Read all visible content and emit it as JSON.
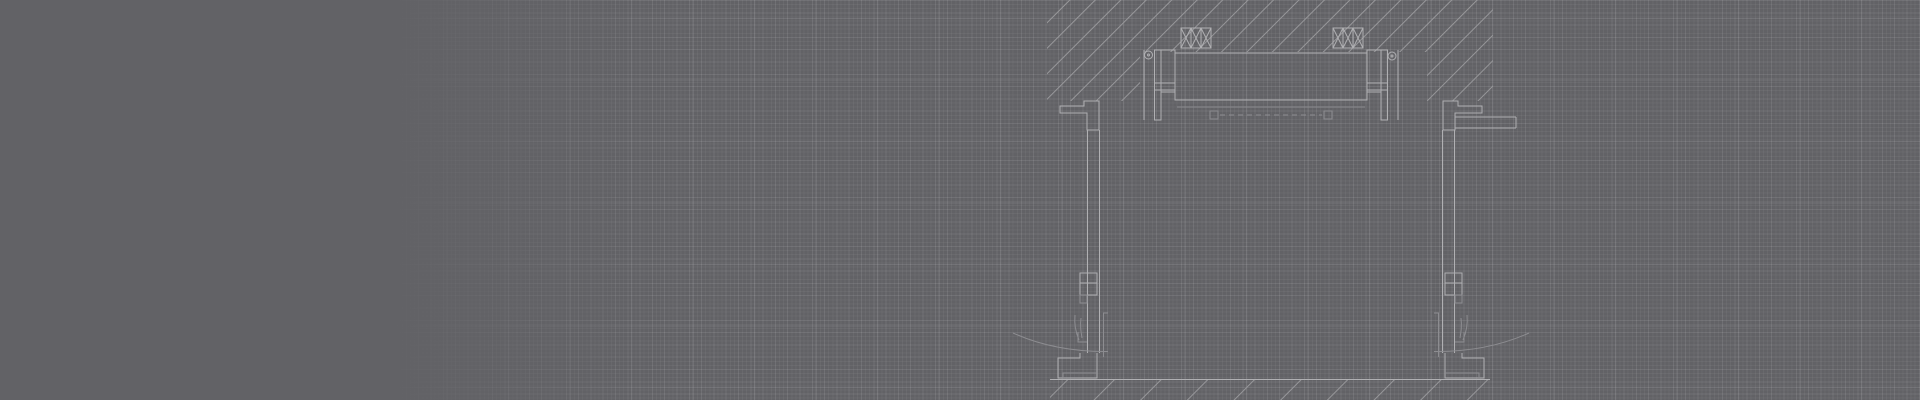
{
  "scene": {
    "background_color": "#626266",
    "grid": {
      "fine_spacing_px": 4.1,
      "fine_color": "rgba(255,255,255,0.045)",
      "medium_spacing_px": 12.3,
      "medium_color": "rgba(255,255,255,0.05)",
      "major_spacing_px": 61.5,
      "major_color": "rgba(255,255,255,0.10)",
      "major_offset_x_px": 16,
      "major_offset_y_px": 18,
      "fade_solid_until_px": 390,
      "fade_transparent_at_px": 660
    },
    "drawing": {
      "main_line_color": "#b0b0b3",
      "dim_line_color": "#8d8d91",
      "hatch_line_color": "#97979a",
      "viewbox": "0 0 1920 400",
      "hatches": [
        {
          "id": "hatch-wall",
          "spacing": 18
        },
        {
          "id": "hatch-floor",
          "spacing": 33
        }
      ],
      "elements": [
        {
          "name": "wall-section-hatch",
          "kind": "polygon-hatch",
          "hatch": "hatch-wall",
          "points": "1047,0 1493,0 1493,101 1427,101 1427,52 1140,52 1140,101 1047,101"
        },
        {
          "name": "floor-section-hatch",
          "kind": "polygon-hatch",
          "hatch": "hatch-floor",
          "points": "1050,380 1490,380 1490,400 1050,400"
        },
        {
          "name": "floor-ground-line",
          "kind": "line",
          "x1": 1050,
          "y1": 379.5,
          "x2": 1490,
          "y2": 379.5
        },
        {
          "name": "head-screw-left",
          "kind": "circle",
          "cx": 1148.5,
          "cy": 55,
          "r": 4
        },
        {
          "name": "head-screw-left-center",
          "kind": "circle",
          "cx": 1148.5,
          "cy": 55,
          "r": 1
        },
        {
          "name": "head-anchor-line-left",
          "kind": "line",
          "x1": 1144,
          "y1": 50,
          "x2": 1144,
          "y2": 120
        },
        {
          "name": "head-post-left",
          "kind": "rect",
          "x": 1154.5,
          "y": 50,
          "w": 6.5,
          "h": 70
        },
        {
          "name": "head-packer-left",
          "kind": "rect",
          "x": 1161,
          "y": 50,
          "w": 14,
          "h": 42
        },
        {
          "name": "head-bridge-left-top",
          "kind": "line",
          "x1": 1155,
          "y1": 83,
          "x2": 1175,
          "y2": 83
        },
        {
          "name": "head-bridge-left-bottom",
          "kind": "line",
          "x1": 1155,
          "y1": 90,
          "x2": 1175,
          "y2": 90
        },
        {
          "name": "door-head-lintel",
          "kind": "rect",
          "x": 1175,
          "y": 53,
          "w": 192,
          "h": 47
        },
        {
          "name": "lintel-under-line",
          "kind": "line",
          "x1": 1177,
          "y1": 107,
          "x2": 1365,
          "y2": 107,
          "tone": "dim"
        },
        {
          "name": "insulation-block-left",
          "kind": "xbox",
          "x": 1181,
          "y": 28,
          "w": 30,
          "h": 20,
          "cells": 3
        },
        {
          "name": "insulation-block-right",
          "kind": "xbox",
          "x": 1333,
          "y": 28,
          "w": 30,
          "h": 20,
          "cells": 3
        },
        {
          "name": "head-packer-right",
          "kind": "rect",
          "x": 1367,
          "y": 50,
          "w": 14,
          "h": 42
        },
        {
          "name": "head-bridge-right-top",
          "kind": "line",
          "x1": 1367,
          "y1": 83,
          "x2": 1387,
          "y2": 83
        },
        {
          "name": "head-bridge-right-bottom",
          "kind": "line",
          "x1": 1367,
          "y1": 90,
          "x2": 1387,
          "y2": 90
        },
        {
          "name": "head-post-right",
          "kind": "rect",
          "x": 1381,
          "y": 50,
          "w": 6.5,
          "h": 70
        },
        {
          "name": "head-anchor-line-right",
          "kind": "line",
          "x1": 1398,
          "y1": 50,
          "x2": 1398,
          "y2": 120
        },
        {
          "name": "head-screw-right",
          "kind": "circle",
          "cx": 1392,
          "cy": 56,
          "r": 4
        },
        {
          "name": "head-screw-right-center",
          "kind": "circle",
          "cx": 1392,
          "cy": 56,
          "r": 1
        },
        {
          "name": "head-seal-cap-left",
          "kind": "rect",
          "x": 1210,
          "y": 111,
          "w": 8,
          "h": 8,
          "tone": "dim"
        },
        {
          "name": "head-seal-cap-right",
          "kind": "rect",
          "x": 1324,
          "y": 111,
          "w": 8,
          "h": 8,
          "tone": "dim"
        },
        {
          "name": "head-seal-line",
          "kind": "line",
          "x1": 1220,
          "y1": 115,
          "x2": 1322,
          "y2": 115,
          "dash": "5 4",
          "tone": "dim"
        },
        {
          "name": "reveal-block-left",
          "kind": "path",
          "d": "M1060,106 H1084 V101 H1099 V130 H1087 V113 H1060 Z"
        },
        {
          "name": "jamb-left-outer",
          "kind": "line",
          "x1": 1087.5,
          "y1": 130,
          "x2": 1087.5,
          "y2": 353
        },
        {
          "name": "jamb-left-inner",
          "kind": "line",
          "x1": 1099.5,
          "y1": 130,
          "x2": 1099.5,
          "y2": 353
        },
        {
          "name": "leaf-edge-left",
          "kind": "path",
          "d": "M1108,313 H1103.5 V357",
          "tone": "dim"
        },
        {
          "name": "hinge-left-plate-upper",
          "kind": "rect",
          "x": 1080,
          "y": 273,
          "w": 17,
          "h": 10
        },
        {
          "name": "hinge-left-plate-lower",
          "kind": "rect",
          "x": 1080,
          "y": 283,
          "w": 17,
          "h": 12
        },
        {
          "name": "hinge-left-pin",
          "kind": "rect",
          "x": 1080,
          "y": 295,
          "w": 7,
          "h": 8,
          "tone": "dim"
        },
        {
          "name": "latch-left-blade-a",
          "kind": "path",
          "d": "M1075,315 C1074,325 1076,333 1079,340",
          "tone": "dim"
        },
        {
          "name": "latch-left-blade-b",
          "kind": "path",
          "d": "M1081,318 C1080,326 1081,332 1082,338",
          "tone": "dim"
        },
        {
          "name": "latch-left-bracket",
          "kind": "path",
          "d": "M1078,332 V342 H1087",
          "tone": "dim"
        },
        {
          "name": "foot-left",
          "kind": "path",
          "d": "M1080,353 V358 H1058 V378 H1097 V353"
        },
        {
          "name": "foot-left-inner",
          "kind": "path",
          "d": "M1097,373 H1063 V378",
          "tone": "dim"
        },
        {
          "name": "swing-arc-left",
          "kind": "path",
          "d": "M1108,351.5 Q1055,352 1013,333",
          "tone": "dim"
        },
        {
          "name": "reveal-block-right",
          "kind": "path",
          "d": "M1482,106 H1458 V101 H1443 V130 H1455 V113 H1482 Z"
        },
        {
          "name": "ledge-right-top",
          "kind": "line",
          "x1": 1455,
          "y1": 117,
          "x2": 1516,
          "y2": 117
        },
        {
          "name": "ledge-right-bottom",
          "kind": "line",
          "x1": 1455,
          "y1": 128,
          "x2": 1516,
          "y2": 128
        },
        {
          "name": "ledge-right-cap",
          "kind": "line",
          "x1": 1516,
          "y1": 117,
          "x2": 1516,
          "y2": 128
        },
        {
          "name": "jamb-right-outer",
          "kind": "line",
          "x1": 1454.5,
          "y1": 130,
          "x2": 1454.5,
          "y2": 353
        },
        {
          "name": "jamb-right-inner",
          "kind": "line",
          "x1": 1442.5,
          "y1": 130,
          "x2": 1442.5,
          "y2": 353
        },
        {
          "name": "leaf-edge-right",
          "kind": "path",
          "d": "M1434,313 H1438.5 V357",
          "tone": "dim"
        },
        {
          "name": "hinge-right-plate-upper",
          "kind": "rect",
          "x": 1445,
          "y": 273,
          "w": 17,
          "h": 10
        },
        {
          "name": "hinge-right-plate-lower",
          "kind": "rect",
          "x": 1445,
          "y": 283,
          "w": 17,
          "h": 12
        },
        {
          "name": "hinge-right-pin",
          "kind": "rect",
          "x": 1455,
          "y": 295,
          "w": 7,
          "h": 8,
          "tone": "dim"
        },
        {
          "name": "latch-right-blade-a",
          "kind": "path",
          "d": "M1467,315 C1468,325 1466,333 1463,340",
          "tone": "dim"
        },
        {
          "name": "latch-right-blade-b",
          "kind": "path",
          "d": "M1461,318 C1462,326 1461,332 1460,338",
          "tone": "dim"
        },
        {
          "name": "latch-right-bracket",
          "kind": "path",
          "d": "M1464,332 V342 H1455",
          "tone": "dim"
        },
        {
          "name": "foot-right",
          "kind": "path",
          "d": "M1462,353 V358 H1484 V378 H1445 V353"
        },
        {
          "name": "foot-right-inner",
          "kind": "path",
          "d": "M1445,373 H1479 V378",
          "tone": "dim"
        },
        {
          "name": "swing-arc-right",
          "kind": "path",
          "d": "M1434,351.5 Q1487,352 1529,333",
          "tone": "dim"
        }
      ]
    }
  }
}
